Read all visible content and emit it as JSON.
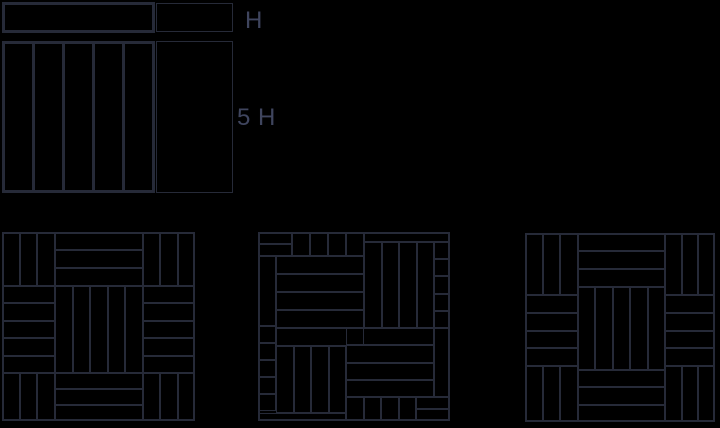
{
  "colors": {
    "background": "#000000",
    "stroke": "#262a38",
    "label": "#3f455e"
  },
  "labels": {
    "plank_height": "H",
    "square_side": "5 H"
  },
  "box_fields": [
    "name",
    "x",
    "y",
    "w",
    "h",
    "dir",
    "strips",
    "border_px",
    "divider_px"
  ],
  "boxes": [
    [
      "plank-h-by-5h",
      2,
      2,
      153,
      31,
      "v",
      1,
      3,
      0
    ],
    [
      "gauge-rect-h",
      156,
      3,
      77,
      29,
      "v",
      1,
      1.5,
      0
    ],
    [
      "square-of-5-planks",
      2,
      41,
      153,
      152,
      "v",
      5,
      3,
      3
    ],
    [
      "gauge-rect-5h",
      156,
      41,
      77,
      152,
      "v",
      1,
      1.5,
      0
    ],
    [
      "pattern1-frame",
      2,
      232,
      193,
      189,
      "v",
      1,
      2,
      0
    ],
    [
      "pattern1-cell-tl",
      2,
      232,
      53,
      54,
      "v",
      3,
      1,
      2
    ],
    [
      "pattern1-cell-tc",
      55,
      232,
      88,
      54,
      "h",
      3,
      1,
      2
    ],
    [
      "pattern1-cell-tr",
      143,
      232,
      52,
      54,
      "v",
      3,
      1,
      2
    ],
    [
      "pattern1-cell-ml",
      2,
      286,
      53,
      87,
      "h",
      5,
      1,
      2
    ],
    [
      "pattern1-cell-cc",
      55,
      286,
      88,
      87,
      "v",
      5,
      1,
      2
    ],
    [
      "pattern1-cell-mr",
      143,
      286,
      52,
      87,
      "h",
      5,
      1,
      2
    ],
    [
      "pattern1-cell-bl",
      2,
      373,
      53,
      48,
      "v",
      3,
      1,
      2
    ],
    [
      "pattern1-cell-bc",
      55,
      373,
      88,
      48,
      "h",
      3,
      1,
      2
    ],
    [
      "pattern1-cell-br",
      143,
      373,
      52,
      48,
      "v",
      3,
      1,
      2
    ],
    [
      "pattern2-frame",
      258,
      232,
      192,
      189,
      "v",
      1,
      2,
      0
    ],
    [
      "pattern2-corner-tl",
      258,
      232,
      34,
      24,
      "h",
      2,
      1,
      2
    ],
    [
      "pattern2-top-planks",
      292,
      232,
      72,
      24,
      "v",
      4,
      1,
      2
    ],
    [
      "pattern2-band-tr",
      364,
      232,
      86,
      10,
      "h",
      1,
      1,
      2
    ],
    [
      "pattern2-block-tr",
      364,
      242,
      70,
      86,
      "v",
      4,
      1,
      2
    ],
    [
      "pattern2-col-right",
      434,
      242,
      16,
      86,
      "h",
      5,
      1,
      2
    ],
    [
      "pattern2-plank-left",
      258,
      256,
      18,
      70,
      "v",
      1,
      1,
      2
    ],
    [
      "pattern2-block-tl",
      276,
      256,
      88,
      90,
      "h",
      5,
      1,
      2
    ],
    [
      "pattern2-col-left",
      258,
      326,
      18,
      85,
      "h",
      5,
      1,
      2
    ],
    [
      "pattern2-block-bl",
      276,
      346,
      70,
      67,
      "v",
      4,
      1,
      2
    ],
    [
      "pattern2-block-br",
      346,
      328,
      88,
      69,
      "h",
      4,
      1,
      2
    ],
    [
      "pattern2-plank-right",
      434,
      328,
      16,
      69,
      "v",
      1,
      1,
      2
    ],
    [
      "pattern2-bottom-planks",
      346,
      397,
      70,
      24,
      "v",
      4,
      1,
      2
    ],
    [
      "pattern2-corner-br",
      416,
      397,
      34,
      24,
      "h",
      2,
      1,
      2
    ],
    [
      "pattern2-band-bl",
      258,
      413,
      88,
      8,
      "h",
      1,
      1,
      2
    ],
    [
      "pattern3-frame",
      525,
      233,
      190,
      189,
      "v",
      1,
      2,
      0
    ],
    [
      "pattern3-cell-tl",
      525,
      233,
      53,
      62,
      "v",
      3,
      1,
      2
    ],
    [
      "pattern3-cell-tc",
      578,
      233,
      87,
      54,
      "h",
      3,
      1,
      2
    ],
    [
      "pattern3-cell-tr",
      665,
      233,
      50,
      62,
      "v",
      3,
      1,
      2
    ],
    [
      "pattern3-cell-ml",
      525,
      295,
      53,
      71,
      "h",
      4,
      1,
      2
    ],
    [
      "pattern3-cell-cc",
      578,
      287,
      87,
      83,
      "v",
      5,
      1,
      2
    ],
    [
      "pattern3-cell-mr",
      665,
      295,
      50,
      71,
      "h",
      4,
      1,
      2
    ],
    [
      "pattern3-cell-bl",
      525,
      366,
      53,
      56,
      "v",
      3,
      1,
      2
    ],
    [
      "pattern3-cell-bc",
      578,
      370,
      87,
      52,
      "h",
      3,
      1,
      2
    ],
    [
      "pattern3-cell-br",
      665,
      366,
      50,
      56,
      "v",
      3,
      1,
      2
    ]
  ]
}
